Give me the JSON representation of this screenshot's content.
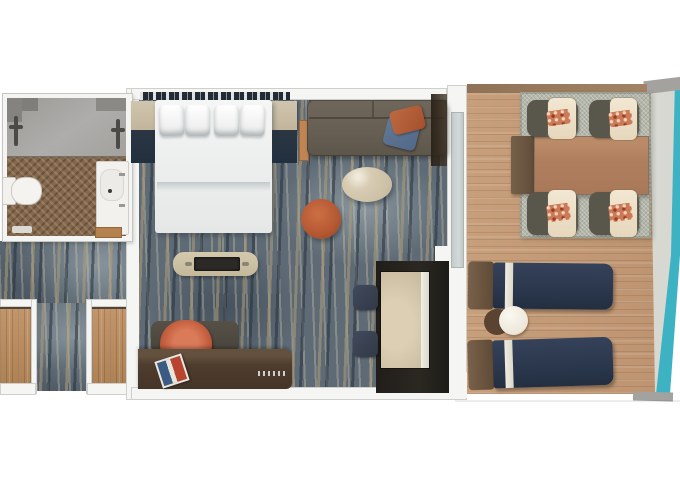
{
  "meta": {
    "description": "Top-down 3D rendered floor plan of a cruise-ship balcony stateroom",
    "text_on_image": "none"
  },
  "palette": {
    "background": "#ffffff",
    "wall": "#f5f5f3",
    "carpet_blue": "#5e6b76",
    "carpet_tan": "#b09c76",
    "entry_wood": "#bb8f61",
    "bathroom_floor_wood": "#85674a",
    "shower_gray": "#a6a5a1",
    "bed_white": "#f0f2f1",
    "nightstand_beige": "#c9bda6",
    "sofa_taupe": "#675f53",
    "pillow_orange": "#b35f38",
    "pillow_blue": "#5b7390",
    "coffee_table_cream": "#d2c6ae",
    "pouf_orange": "#b65a34",
    "console_beige": "#cfc3a8",
    "desk_brown": "#4e3c2d",
    "desk_chair_orange": "#c05a3b",
    "closet_dark": "#26231f",
    "mirror_beige": "#c4b69b",
    "stool_navy": "#38404e",
    "deck_wood": "#c69d79",
    "balcony_rug": "#b4b7aa",
    "dining_table_wood": "#b07f5e",
    "chair_frame_gray": "#59564c",
    "chair_cushion_cream": "#eee1ca",
    "chair_pillow_coral": "#c97a57",
    "lounger_navy": "#2e3b51",
    "lounger_stripe": "#e9e5da",
    "lounger_headrest": "#6d5741",
    "hull_teal": "#3cb2c3",
    "trim_gray": "#a3a29e"
  },
  "rooms": {
    "bathroom": {
      "label": "Bathroom"
    },
    "entry": {
      "label": "Entry hallway with closets"
    },
    "bedroom": {
      "label": "Stateroom"
    },
    "balcony": {
      "label": "Private balcony"
    }
  },
  "items": {
    "shower": "Walk-in shower",
    "shower_fixture": "Shower fixture",
    "toilet": "Toilet",
    "vanity": "Vanity sink",
    "bath_mat": "Bath mat",
    "bath_door": "Bathroom door threshold",
    "headboard": "Headboard accent wall",
    "bed": "Bed with pillows and duvet",
    "pillow": "Bed pillow",
    "nightstand": "Nightstand",
    "ladder_shelf": "Wood side rack",
    "sofa": "Sofa",
    "sofa_pillow_orange": "Orange throw pillow",
    "sofa_pillow_blue": "Blue throw pillow",
    "curtain": "Window curtain",
    "coffee_table": "Oval coffee table",
    "pouf": "Round orange pouf",
    "tv_console": "TV console bench",
    "desk": "Desk",
    "desk_chair": "Desk chair",
    "magazine": "Magazine on desk",
    "closet": "Wardrobe closet",
    "mirror": "Mirrored closet door",
    "stool": "Navy stool",
    "glass_door": "Balcony glass door",
    "deck": "Balcony wood deck",
    "balcony_rug": "Outdoor rug",
    "dining_table": "Balcony dining table",
    "dining_bench": "Dining table end bench",
    "dining_chair": "Balcony dining chair",
    "lounger": "Sun lounger",
    "side_table_white": "Round side table",
    "side_table_dark": "Side table shadow base",
    "hull": "Ship hull edge"
  }
}
